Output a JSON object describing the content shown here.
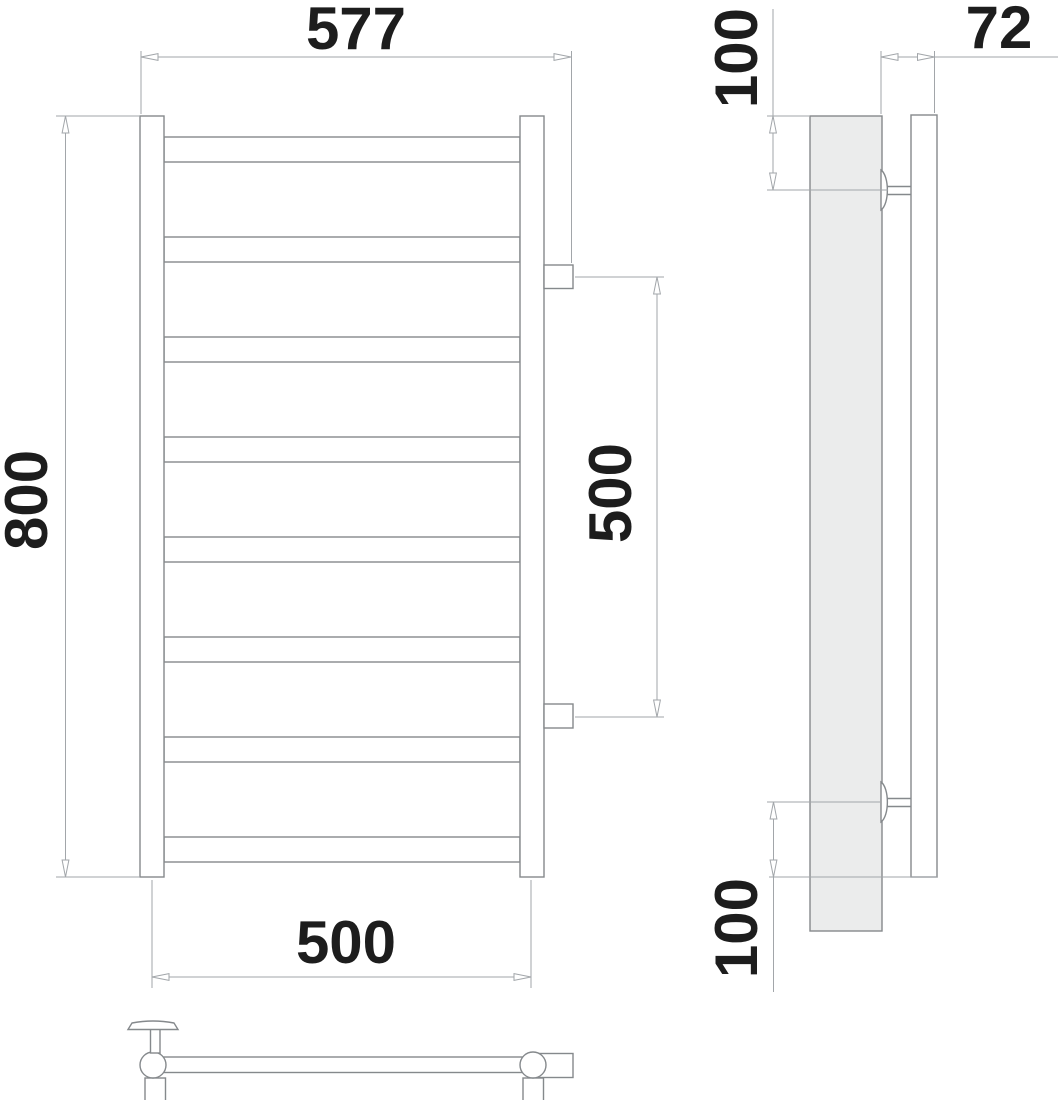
{
  "drawing": {
    "title": "towel-rail-dimension-drawing",
    "views": {
      "front": {
        "rung_count": 8,
        "connector_count": 2,
        "post_count": 2
      },
      "side": {
        "bracket_count": 2
      },
      "top": {
        "post_section_count": 2
      }
    },
    "labels": {
      "overall_width": "577",
      "height": "800",
      "pipe_center_width": "500",
      "connector_spacing": "500",
      "top_bracket_offset": "100",
      "bottom_bracket_offset": "100",
      "wall_depth": "72"
    },
    "colors": {
      "object_line": "#85898c",
      "dimension_line": "#a2a6aa",
      "text": "#1d1d1d",
      "body_fill": "#ebecec",
      "background": "#ffffff"
    }
  }
}
